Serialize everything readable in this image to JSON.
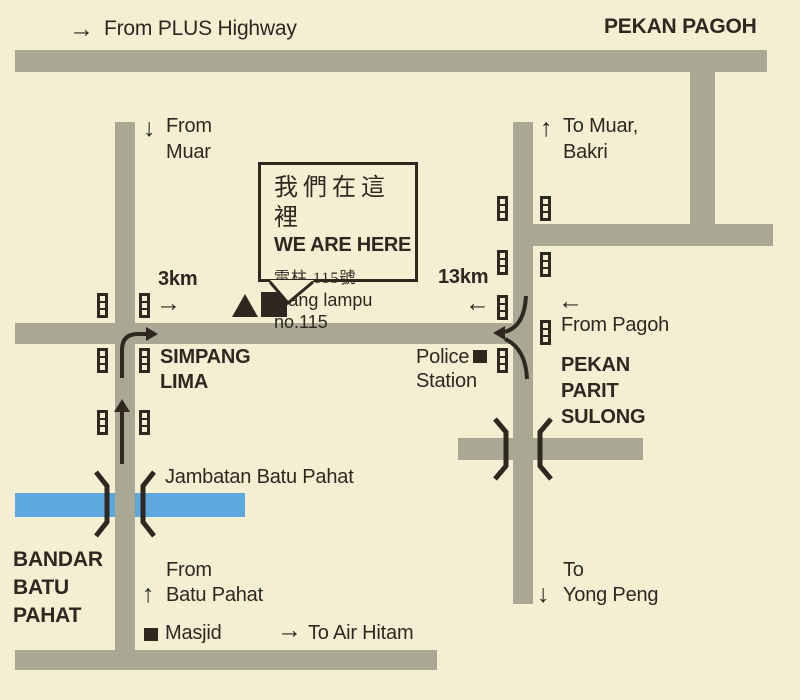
{
  "map": {
    "colors": {
      "background": "#f4eed2",
      "road": "#aaa795",
      "river": "#5da8dc",
      "ink": "#2e2821"
    },
    "labels": {
      "from_plus_highway": {
        "arrow": "→",
        "text": "From PLUS Highway"
      },
      "pekan_pagoh": {
        "text": "PEKAN PAGOH"
      },
      "from_muar": {
        "arrow": "↓",
        "line1": "From",
        "line2": "Muar"
      },
      "to_muar_bakri": {
        "arrow": "↑",
        "line1": "To Muar,",
        "line2": "Bakri"
      },
      "distance_3km": {
        "text": "3km",
        "arrow": "→"
      },
      "distance_13km": {
        "text": "13km",
        "arrow": "←"
      },
      "from_pagoh": {
        "arrow": "←",
        "text": "From Pagoh"
      },
      "simpang_lima": {
        "line1": "SIMPANG",
        "line2": "LIMA"
      },
      "police_station": {
        "line1": "Police",
        "line2": "Station"
      },
      "pekan_parit_sulong": {
        "line1": "PEKAN",
        "line2": "PARIT",
        "line3": "SULONG"
      },
      "jambatan_batu_pahat": {
        "text": "Jambatan Batu Pahat"
      },
      "bandar_batu_pahat": {
        "line1": "BANDAR",
        "line2": "BATU",
        "line3": "PAHAT"
      },
      "from_batu_pahat": {
        "arrow": "↑",
        "line1": "From",
        "line2": "Batu Pahat"
      },
      "masjid": {
        "text": "Masjid"
      },
      "to_air_hitam": {
        "arrow": "→",
        "text": "To Air Hitam"
      },
      "to_yong_peng": {
        "arrow": "↓",
        "line1": "To",
        "line2": "Yong Peng"
      }
    },
    "callout": {
      "line1_zh": "我們在這裡",
      "line2_en": "WE ARE HERE",
      "line3_zh": "電柱 115號",
      "line4_malay": "Tiang lampu no.115"
    }
  }
}
